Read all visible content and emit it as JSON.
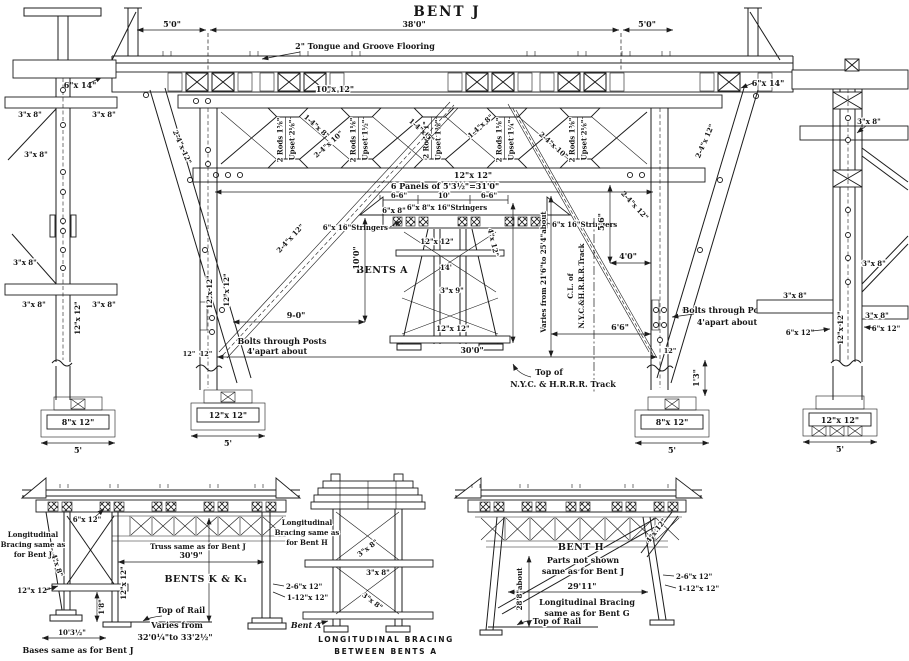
{
  "title": "BENT J",
  "main": {
    "d5l": "5'0\"",
    "span": "38'0\"",
    "d5r": "5'0\"",
    "flooring": "2\" Tongue and Groove Flooring",
    "wall_l": "6\"x 14\"",
    "wall_r": "6\"x 14\"",
    "top_chord": "10\"x 12\"",
    "bottom_chord": "12\"x 12\"",
    "batter_l": "2-4\"x 12\"",
    "batter_r": "2-4\"x 12\"",
    "diag_l": "2-4\"x 12\"",
    "diag_r": "2-4\"x 12\"",
    "tdiag": [
      "1-4\"x 8\"",
      "2-4\"x 10\"",
      "1-4\"x 5\"",
      "1-4\"x 8\"",
      "2-4\"x 10\""
    ],
    "rods": [
      {
        "r": "2 Rods 1⅝\"",
        "u": "Upset 2⅛\""
      },
      {
        "r": "2 Rods 1⅛\"",
        "u": "Upset 1½\""
      },
      {
        "r": "2 Rods 1\"",
        "u": "Upset 1⅜\""
      },
      {
        "r": "2 Rods 1⅛\"",
        "u": "Upset 1¼\""
      },
      {
        "r": "2 Rods 1⅝\"",
        "u": "Upset 2⅛\""
      }
    ],
    "post_l1": "12\"x 12\"",
    "post_l2": "12\"x 12\"",
    "w12a": "12\"",
    "w12b": "12\"",
    "panels": "6 Panels of 5'3½\"=31'0\"",
    "d66l": "6-6\"",
    "d10": "10'",
    "d66r": "6-6\"",
    "str_top": "6\"x 8\"x 16\"Stringers",
    "str_l": "6\"x 16\"Stringers",
    "str_r": "6\"x 16\"Stringers",
    "s68": "6\"x 8\"",
    "bents_a": "BENTS A",
    "tw_top": "12\"x 12\"",
    "tw_h": "14'",
    "tw_brace": "3\"x 9\"",
    "tw_bot": "12\"x 12\"",
    "tw_leg": "4\"x 12\"",
    "d90": "9-0\"",
    "d100": "10'0\"",
    "d300": "30'0\"",
    "bolts1": "Bolts through Posts",
    "bolts2": "4'apart about",
    "varies": "Varies from 21'6\"to 25'4\"about",
    "cl1": "C.L. of",
    "cl2": "N.Y.C.&H.R.R.R.Track",
    "top1": "Top of",
    "top2": "N.Y.C. & H.R.R.R. Track",
    "d56": "5'6\"",
    "d40": "4'0\"",
    "d66": "6'6\"",
    "d12": "12\"",
    "d13": "1'3\"",
    "ft_lm": "12\"x 12\"",
    "ft_rm": "8\"x 12\"",
    "ft5": "5'"
  },
  "left_view": {
    "s38": "3\"x 8\"",
    "post": "12\"x 12\"",
    "ft": "8\"x 12\""
  },
  "right_view": {
    "s38": "3\"x 8\"",
    "s612": "6\"x 12\"",
    "post": "12\"x 12\"",
    "ft": "12\"x 12\""
  },
  "kk": {
    "n1": "Longitudinal",
    "n2": "Bracing same as",
    "n3": "for Bent J",
    "cap": "6\"x 12\"",
    "truss": "Truss same as for Bent J",
    "dim": "30'9\"",
    "title": "BENTS K & K₁",
    "leg": "4\"x 8\"",
    "post_l": "12\"x 12\"",
    "post_r": "12\"x 12\"",
    "d18": "1'8\"",
    "r1": "2-6\"x 12\"",
    "r2": "1-12\"x 12\"",
    "rail": "Top of Rail",
    "v1": "Varies from",
    "v2": "32'0¼\"to 33'2½\"",
    "d103": "10'3½\"",
    "bases": "Bases same as for Bent J"
  },
  "ba": {
    "n1": "Longitudinal",
    "n2": "Bracing same as",
    "n3": "for Bent H",
    "s38": "3\"x 8\"",
    "label": "Bent A",
    "c1": "LONGITUDINAL BRACING",
    "c2": "BETWEEN BENTS A"
  },
  "bh": {
    "title": "BENT H",
    "n1": "Parts not shown",
    "n2": "same as for Bent J",
    "leg": "4\"x 12\"",
    "r1": "2-6\"x 12\"",
    "r2": "1-12\"x 12\"",
    "dim": "29'11\"",
    "n3": "Longitudinal Bracing",
    "n4": "same as for Bent G",
    "h": "28'8\"about",
    "rail": "Top of Rail"
  }
}
